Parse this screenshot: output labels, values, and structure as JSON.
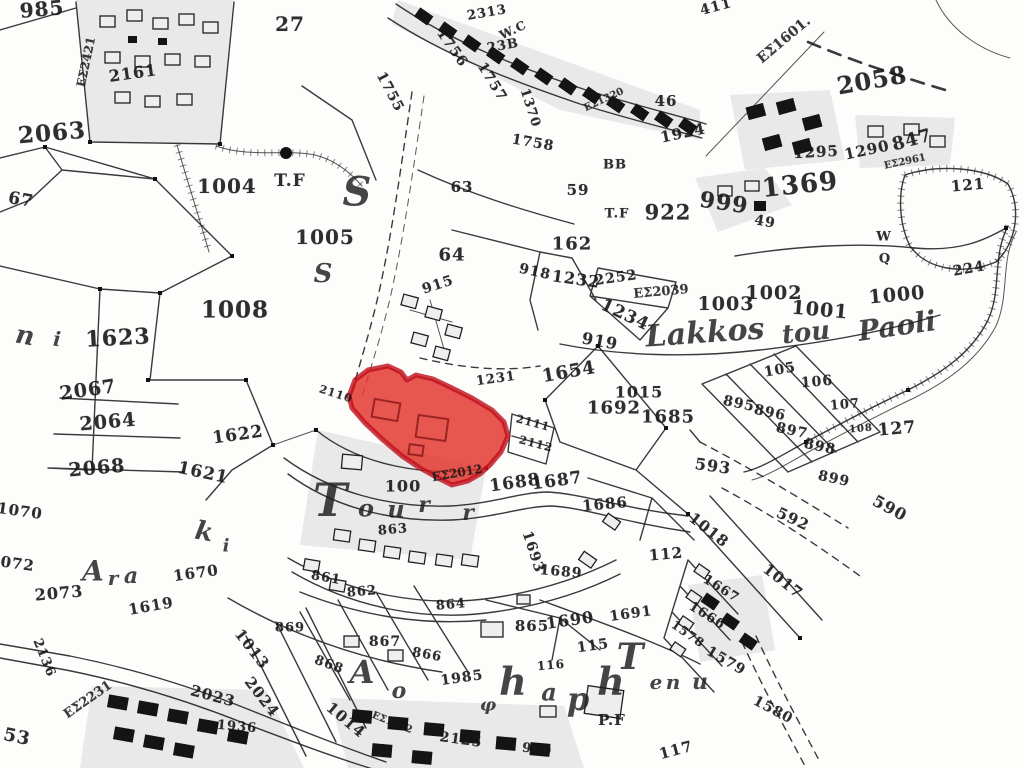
{
  "map": {
    "kind": "cadastral-survey-map",
    "background": "#fdfdfc",
    "ink": "#1f1f1f",
    "highlight_fill": "#e23128",
    "highlight_border": "#bf0f1c",
    "highlighted_parcel_note": "red-highlighted parcel group near map centre"
  },
  "parcel_labels": [
    {
      "t": "985",
      "x": 42,
      "y": 9,
      "s": 20,
      "r": -5
    },
    {
      "t": "ΕΣ2421",
      "x": 86,
      "y": 62,
      "s": 12,
      "r": -78,
      "cls": "code"
    },
    {
      "t": "2161",
      "x": 133,
      "y": 73,
      "s": 16,
      "r": -8
    },
    {
      "t": "27",
      "x": 290,
      "y": 24,
      "s": 20,
      "r": 0
    },
    {
      "t": "1004",
      "x": 227,
      "y": 186,
      "s": 20,
      "r": 0
    },
    {
      "t": "T.F",
      "x": 290,
      "y": 181,
      "s": 17,
      "r": 0
    },
    {
      "t": "1005",
      "x": 325,
      "y": 237,
      "s": 20,
      "r": 0
    },
    {
      "t": "67",
      "x": 21,
      "y": 200,
      "s": 17,
      "r": 10
    },
    {
      "t": "1755",
      "x": 390,
      "y": 92,
      "s": 14,
      "r": 62
    },
    {
      "t": "1756",
      "x": 452,
      "y": 48,
      "s": 14,
      "r": 55
    },
    {
      "t": "1757",
      "x": 492,
      "y": 82,
      "s": 14,
      "r": 58
    },
    {
      "t": "2313",
      "x": 487,
      "y": 13,
      "s": 13,
      "r": -10
    },
    {
      "t": "W.C",
      "x": 513,
      "y": 30,
      "s": 12,
      "r": -25
    },
    {
      "t": "23B",
      "x": 503,
      "y": 46,
      "s": 13,
      "r": -10
    },
    {
      "t": "1370",
      "x": 530,
      "y": 108,
      "s": 13,
      "r": 72
    },
    {
      "t": "1758",
      "x": 533,
      "y": 143,
      "s": 14,
      "r": 10
    },
    {
      "t": "ΕΣ1320",
      "x": 604,
      "y": 100,
      "s": 10,
      "r": -25,
      "cls": "code"
    },
    {
      "t": "2058",
      "x": 872,
      "y": 80,
      "s": 24,
      "r": -10
    },
    {
      "t": "1369",
      "x": 800,
      "y": 185,
      "s": 26,
      "r": -6
    },
    {
      "t": "ΕΣ1601.",
      "x": 784,
      "y": 40,
      "s": 14,
      "r": -40,
      "cls": "code"
    },
    {
      "t": "411",
      "x": 716,
      "y": 7,
      "s": 14,
      "r": -15
    },
    {
      "t": "46",
      "x": 666,
      "y": 101,
      "s": 15,
      "r": 0
    },
    {
      "t": "1924",
      "x": 683,
      "y": 133,
      "s": 15,
      "r": -12
    },
    {
      "t": "BB",
      "x": 615,
      "y": 165,
      "s": 13,
      "r": 0
    },
    {
      "t": "59",
      "x": 578,
      "y": 190,
      "s": 15,
      "r": 0
    },
    {
      "t": "63",
      "x": 462,
      "y": 187,
      "s": 15,
      "r": 0
    },
    {
      "t": "T.F",
      "x": 617,
      "y": 214,
      "s": 13,
      "r": 0
    },
    {
      "t": "922",
      "x": 668,
      "y": 212,
      "s": 21,
      "r": 0
    },
    {
      "t": "999",
      "x": 724,
      "y": 203,
      "s": 22,
      "r": 8
    },
    {
      "t": "49",
      "x": 765,
      "y": 222,
      "s": 14,
      "r": 10
    },
    {
      "t": "1295",
      "x": 816,
      "y": 152,
      "s": 15,
      "r": -3
    },
    {
      "t": "1290",
      "x": 867,
      "y": 150,
      "s": 15,
      "r": -12
    },
    {
      "t": "847",
      "x": 912,
      "y": 140,
      "s": 18,
      "r": -15
    },
    {
      "t": "ΕΣ2961",
      "x": 905,
      "y": 162,
      "s": 10,
      "r": -12,
      "cls": "code"
    },
    {
      "t": "121",
      "x": 968,
      "y": 185,
      "s": 15,
      "r": -5
    },
    {
      "t": "W",
      "x": 884,
      "y": 237,
      "s": 13,
      "r": 0
    },
    {
      "t": "Q",
      "x": 885,
      "y": 259,
      "s": 13,
      "r": 0
    },
    {
      "t": "224",
      "x": 969,
      "y": 269,
      "s": 14,
      "r": -10
    },
    {
      "t": "2063",
      "x": 52,
      "y": 133,
      "s": 23,
      "r": -5
    },
    {
      "t": "1623",
      "x": 118,
      "y": 338,
      "s": 22,
      "r": -3
    },
    {
      "t": "1008",
      "x": 235,
      "y": 310,
      "s": 23,
      "r": 0
    },
    {
      "t": "2067",
      "x": 88,
      "y": 390,
      "s": 19,
      "r": -8
    },
    {
      "t": "2064",
      "x": 108,
      "y": 422,
      "s": 19,
      "r": -5
    },
    {
      "t": "2068",
      "x": 97,
      "y": 468,
      "s": 19,
      "r": -5
    },
    {
      "t": "1622",
      "x": 238,
      "y": 435,
      "s": 17,
      "r": -8
    },
    {
      "t": "1621",
      "x": 203,
      "y": 473,
      "s": 17,
      "r": 12
    },
    {
      "t": "2110",
      "x": 336,
      "y": 394,
      "s": 11,
      "r": 18
    },
    {
      "t": "915",
      "x": 438,
      "y": 285,
      "s": 14,
      "r": -18
    },
    {
      "t": "64",
      "x": 452,
      "y": 255,
      "s": 18,
      "r": 0
    },
    {
      "t": "162",
      "x": 572,
      "y": 244,
      "s": 18,
      "r": 0
    },
    {
      "t": "918",
      "x": 535,
      "y": 272,
      "s": 14,
      "r": 12
    },
    {
      "t": "1232",
      "x": 576,
      "y": 279,
      "s": 16,
      "r": 8
    },
    {
      "t": "2252",
      "x": 616,
      "y": 278,
      "s": 14,
      "r": -8
    },
    {
      "t": "ΕΣ2039",
      "x": 661,
      "y": 292,
      "s": 13,
      "r": -5,
      "cls": "code"
    },
    {
      "t": "1234",
      "x": 625,
      "y": 315,
      "s": 17,
      "r": 25
    },
    {
      "t": "919",
      "x": 600,
      "y": 341,
      "s": 16,
      "r": 10
    },
    {
      "t": "1003",
      "x": 726,
      "y": 304,
      "s": 19,
      "r": 0
    },
    {
      "t": "1002",
      "x": 774,
      "y": 293,
      "s": 19,
      "r": 0
    },
    {
      "t": "1001",
      "x": 820,
      "y": 310,
      "s": 19,
      "r": 5
    },
    {
      "t": "1000",
      "x": 897,
      "y": 295,
      "s": 19,
      "r": -5
    },
    {
      "t": "1654",
      "x": 569,
      "y": 372,
      "s": 18,
      "r": -10
    },
    {
      "t": "1015",
      "x": 639,
      "y": 392,
      "s": 16,
      "r": 0
    },
    {
      "t": "1692",
      "x": 614,
      "y": 408,
      "s": 18,
      "r": 0
    },
    {
      "t": "1685",
      "x": 668,
      "y": 417,
      "s": 18,
      "r": 0
    },
    {
      "t": "1231",
      "x": 496,
      "y": 379,
      "s": 13,
      "r": -8
    },
    {
      "t": "2111",
      "x": 533,
      "y": 423,
      "s": 11,
      "r": 15
    },
    {
      "t": "2112",
      "x": 536,
      "y": 444,
      "s": 11,
      "r": 15
    },
    {
      "t": "105",
      "x": 780,
      "y": 370,
      "s": 14,
      "r": -10
    },
    {
      "t": "106",
      "x": 817,
      "y": 382,
      "s": 14,
      "r": -5
    },
    {
      "t": "107",
      "x": 845,
      "y": 405,
      "s": 13,
      "r": -5
    },
    {
      "t": "108",
      "x": 861,
      "y": 429,
      "s": 10,
      "r": -5
    },
    {
      "t": "127",
      "x": 897,
      "y": 429,
      "s": 17,
      "r": -5
    },
    {
      "t": "895",
      "x": 739,
      "y": 404,
      "s": 14,
      "r": 12
    },
    {
      "t": "896",
      "x": 770,
      "y": 413,
      "s": 14,
      "r": 12
    },
    {
      "t": "897",
      "x": 792,
      "y": 431,
      "s": 14,
      "r": 12
    },
    {
      "t": "898",
      "x": 820,
      "y": 447,
      "s": 14,
      "r": 12
    },
    {
      "t": "899",
      "x": 834,
      "y": 479,
      "s": 14,
      "r": 12
    },
    {
      "t": "593",
      "x": 713,
      "y": 466,
      "s": 16,
      "r": 8
    },
    {
      "t": "592",
      "x": 793,
      "y": 519,
      "s": 15,
      "r": 25
    },
    {
      "t": "590",
      "x": 890,
      "y": 508,
      "s": 16,
      "r": 28
    },
    {
      "t": "100",
      "x": 403,
      "y": 486,
      "s": 16,
      "r": 0
    },
    {
      "t": "ΕΣ2012",
      "x": 457,
      "y": 473,
      "s": 12,
      "r": -10,
      "cls": "code"
    },
    {
      "t": "1688",
      "x": 515,
      "y": 483,
      "s": 17,
      "r": -8
    },
    {
      "t": "1687",
      "x": 557,
      "y": 481,
      "s": 17,
      "r": -8
    },
    {
      "t": "1686",
      "x": 605,
      "y": 504,
      "s": 15,
      "r": -5
    },
    {
      "t": "112",
      "x": 666,
      "y": 554,
      "s": 15,
      "r": -5
    },
    {
      "t": "1693",
      "x": 533,
      "y": 552,
      "s": 14,
      "r": 72
    },
    {
      "t": "1689",
      "x": 561,
      "y": 572,
      "s": 14,
      "r": 5
    },
    {
      "t": "1690",
      "x": 570,
      "y": 620,
      "s": 16,
      "r": -8
    },
    {
      "t": "1691",
      "x": 631,
      "y": 614,
      "s": 14,
      "r": -8
    },
    {
      "t": "115",
      "x": 593,
      "y": 646,
      "s": 14,
      "r": -8
    },
    {
      "t": "116",
      "x": 551,
      "y": 665,
      "s": 12,
      "r": -5
    },
    {
      "t": "117",
      "x": 676,
      "y": 750,
      "s": 15,
      "r": -15
    },
    {
      "t": "1018",
      "x": 709,
      "y": 530,
      "s": 15,
      "r": 38
    },
    {
      "t": "1017",
      "x": 783,
      "y": 581,
      "s": 15,
      "r": 38
    },
    {
      "t": "1667",
      "x": 721,
      "y": 589,
      "s": 13,
      "r": 32
    },
    {
      "t": "1666",
      "x": 707,
      "y": 616,
      "s": 13,
      "r": 32
    },
    {
      "t": "1578",
      "x": 688,
      "y": 634,
      "s": 12,
      "r": 35
    },
    {
      "t": "1579",
      "x": 726,
      "y": 661,
      "s": 14,
      "r": 30
    },
    {
      "t": "1580",
      "x": 773,
      "y": 710,
      "s": 14,
      "r": 28
    },
    {
      "t": "863",
      "x": 393,
      "y": 530,
      "s": 13,
      "r": -5
    },
    {
      "t": "861",
      "x": 326,
      "y": 578,
      "s": 13,
      "r": 10
    },
    {
      "t": "862",
      "x": 362,
      "y": 592,
      "s": 13,
      "r": -5
    },
    {
      "t": "864",
      "x": 451,
      "y": 605,
      "s": 13,
      "r": -5
    },
    {
      "t": "865",
      "x": 532,
      "y": 626,
      "s": 15,
      "r": 0
    },
    {
      "t": "866",
      "x": 427,
      "y": 655,
      "s": 13,
      "r": 10
    },
    {
      "t": "867",
      "x": 385,
      "y": 642,
      "s": 14,
      "r": 0
    },
    {
      "t": "868",
      "x": 329,
      "y": 665,
      "s": 13,
      "r": 20
    },
    {
      "t": "869",
      "x": 290,
      "y": 628,
      "s": 13,
      "r": 0
    },
    {
      "t": "1985",
      "x": 462,
      "y": 678,
      "s": 14,
      "r": -8
    },
    {
      "t": "2125",
      "x": 461,
      "y": 740,
      "s": 14,
      "r": 8
    },
    {
      "t": "960",
      "x": 537,
      "y": 750,
      "s": 13,
      "r": 8
    },
    {
      "t": "P.F",
      "x": 612,
      "y": 720,
      "s": 15,
      "r": 0
    },
    {
      "t": "1670",
      "x": 196,
      "y": 573,
      "s": 15,
      "r": -8
    },
    {
      "t": "1619",
      "x": 151,
      "y": 606,
      "s": 15,
      "r": -10
    },
    {
      "t": "2073",
      "x": 59,
      "y": 593,
      "s": 16,
      "r": -5
    },
    {
      "t": "2136",
      "x": 44,
      "y": 658,
      "s": 13,
      "r": 68
    },
    {
      "t": "ΕΣ2231",
      "x": 88,
      "y": 700,
      "s": 13,
      "r": -35,
      "cls": "code"
    },
    {
      "t": "2023",
      "x": 213,
      "y": 696,
      "s": 15,
      "r": 15
    },
    {
      "t": "1936",
      "x": 237,
      "y": 727,
      "s": 13,
      "r": 5
    },
    {
      "t": "2024",
      "x": 262,
      "y": 697,
      "s": 15,
      "r": 52
    },
    {
      "t": "1013",
      "x": 252,
      "y": 649,
      "s": 15,
      "r": 52
    },
    {
      "t": "1014",
      "x": 346,
      "y": 720,
      "s": 15,
      "r": 40
    },
    {
      "t": "ΕΣ1422",
      "x": 392,
      "y": 723,
      "s": 10,
      "r": 22,
      "cls": "code"
    },
    {
      "t": "1070",
      "x": 20,
      "y": 511,
      "s": 15,
      "r": 8
    },
    {
      "t": "1072",
      "x": 12,
      "y": 563,
      "s": 15,
      "r": 8
    },
    {
      "t": "53",
      "x": 17,
      "y": 737,
      "s": 18,
      "r": 12
    }
  ],
  "place_letters": [
    {
      "t": "S",
      "x": 357,
      "y": 192,
      "s": 40,
      "r": 0
    },
    {
      "t": "S",
      "x": 323,
      "y": 274,
      "s": 26,
      "r": 0
    },
    {
      "t": "n",
      "x": 25,
      "y": 336,
      "s": 26,
      "r": 10
    },
    {
      "t": "i",
      "x": 57,
      "y": 339,
      "s": 20,
      "r": 5
    },
    {
      "t": "Lakkos",
      "x": 705,
      "y": 333,
      "s": 30,
      "r": -4
    },
    {
      "t": "tou",
      "x": 806,
      "y": 333,
      "s": 26,
      "r": -6
    },
    {
      "t": "Paoli",
      "x": 897,
      "y": 326,
      "s": 28,
      "r": -8
    },
    {
      "t": "T",
      "x": 330,
      "y": 500,
      "s": 46,
      "r": 0
    },
    {
      "t": "o",
      "x": 366,
      "y": 508,
      "s": 24,
      "r": 0
    },
    {
      "t": "u",
      "x": 396,
      "y": 509,
      "s": 24,
      "r": 0
    },
    {
      "t": "r",
      "x": 424,
      "y": 505,
      "s": 22,
      "r": 0
    },
    {
      "t": "r",
      "x": 468,
      "y": 513,
      "s": 22,
      "r": 0
    },
    {
      "t": "k",
      "x": 204,
      "y": 532,
      "s": 26,
      "r": 10
    },
    {
      "t": "i",
      "x": 226,
      "y": 546,
      "s": 18,
      "r": 0
    },
    {
      "t": "A",
      "x": 93,
      "y": 571,
      "s": 28,
      "r": 0
    },
    {
      "t": "r",
      "x": 113,
      "y": 578,
      "s": 20,
      "r": 0
    },
    {
      "t": "a",
      "x": 131,
      "y": 576,
      "s": 22,
      "r": 0
    },
    {
      "t": "A",
      "x": 362,
      "y": 672,
      "s": 32,
      "r": 0
    },
    {
      "t": "o",
      "x": 399,
      "y": 691,
      "s": 22,
      "r": 0
    },
    {
      "t": "φ",
      "x": 488,
      "y": 705,
      "s": 18,
      "r": 0
    },
    {
      "t": "h",
      "x": 513,
      "y": 681,
      "s": 38,
      "r": 0
    },
    {
      "t": "a",
      "x": 549,
      "y": 692,
      "s": 24,
      "r": 0
    },
    {
      "t": "p",
      "x": 578,
      "y": 699,
      "s": 32,
      "r": 0
    },
    {
      "t": "h",
      "x": 611,
      "y": 681,
      "s": 38,
      "r": 0
    },
    {
      "t": "T",
      "x": 630,
      "y": 657,
      "s": 36,
      "r": 0
    },
    {
      "t": "e",
      "x": 656,
      "y": 682,
      "s": 20,
      "r": 0
    },
    {
      "t": "n",
      "x": 673,
      "y": 682,
      "s": 20,
      "r": 0
    },
    {
      "t": "u",
      "x": 700,
      "y": 682,
      "s": 22,
      "r": 0
    }
  ]
}
